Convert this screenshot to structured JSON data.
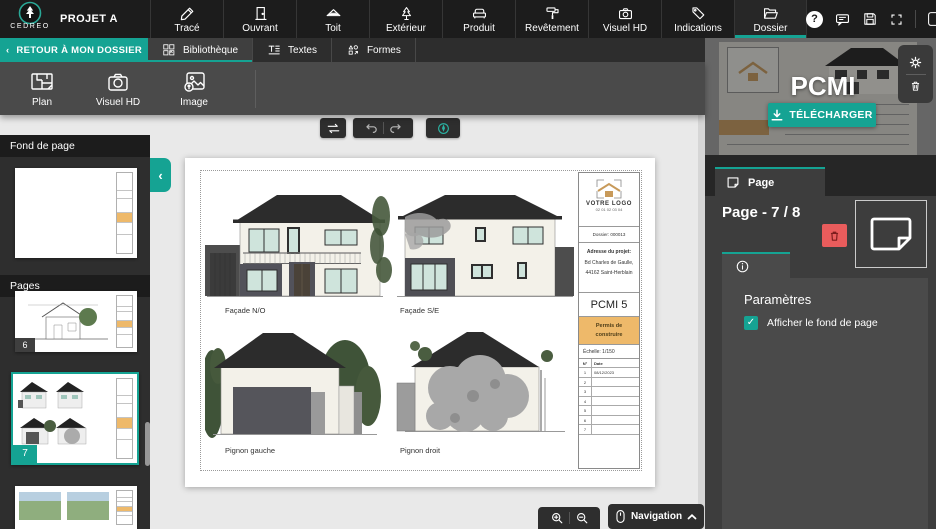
{
  "app": {
    "brand": "CEDREO",
    "project": "PROJET A"
  },
  "top_tabs": [
    {
      "label": "Tracé"
    },
    {
      "label": "Ouvrant"
    },
    {
      "label": "Toit"
    },
    {
      "label": "Extérieur"
    },
    {
      "label": "Produit"
    },
    {
      "label": "Revêtement"
    },
    {
      "label": "Visuel HD"
    },
    {
      "label": "Indications"
    },
    {
      "label": "Dossier",
      "active": true
    }
  ],
  "top_actions": {
    "help_glyph": "?"
  },
  "toolbar": {
    "back_chevron": "‹",
    "back_label": "RETOUR À MON DOSSIER",
    "tabs": [
      {
        "label": "Bibliothèque",
        "active": true
      },
      {
        "label": "Textes"
      },
      {
        "label": "Formes"
      }
    ]
  },
  "insert_buttons": [
    {
      "label": "Plan"
    },
    {
      "label": "Visuel HD"
    },
    {
      "label": "Image"
    }
  ],
  "sidebar": {
    "background_header": "Fond de page",
    "pages_header": "Pages",
    "collapse_glyph": "‹",
    "pages": [
      {
        "number": "6",
        "selected": false
      },
      {
        "number": "7",
        "selected": true
      },
      {
        "number": "",
        "selected": false
      }
    ]
  },
  "document": {
    "labels": {
      "facade_no": "Façade N/O",
      "facade_se": "Façade S/E",
      "pignon_gauche": "Pignon gauche",
      "pignon_droit": "Pignon droit"
    },
    "title_block": {
      "logo_text": "VOTRE LOGO",
      "logo_phone": "02 01 02 03 04",
      "dossier": "Dossier: 000013",
      "address_label": "Adresse du projet:",
      "address_line1": "Bd Charles de Gaulle,",
      "address_line2": "44162 Saint-Herblain",
      "code": "PCMI 5",
      "permit": "Permis de construire",
      "scale": "Échelle: 1/150",
      "table": {
        "headers": [
          "N°",
          "Date"
        ],
        "rows": [
          [
            "1",
            "08/12/2023"
          ],
          [
            "2",
            ""
          ],
          [
            "3",
            ""
          ],
          [
            "4",
            ""
          ],
          [
            "5",
            ""
          ],
          [
            "6",
            ""
          ],
          [
            "7",
            ""
          ]
        ]
      }
    }
  },
  "right_panel": {
    "preview_title": "PCMI",
    "download_label": "TÉLÉCHARGER",
    "tab_label": "Page",
    "page_heading": "Page - 7 / 8",
    "params_title": "Paramètres",
    "checkbox_label": "Afficher le fond de page",
    "checkbox_checked": true,
    "check_glyph": "✓"
  },
  "bottom_bar": {
    "navigation_label": "Navigation",
    "chevron_up": "⌃"
  },
  "colors": {
    "accent": "#15a393",
    "danger": "#e95c5c",
    "permit_orange": "#eeb96a",
    "logo_tan": "#c89a5a"
  }
}
